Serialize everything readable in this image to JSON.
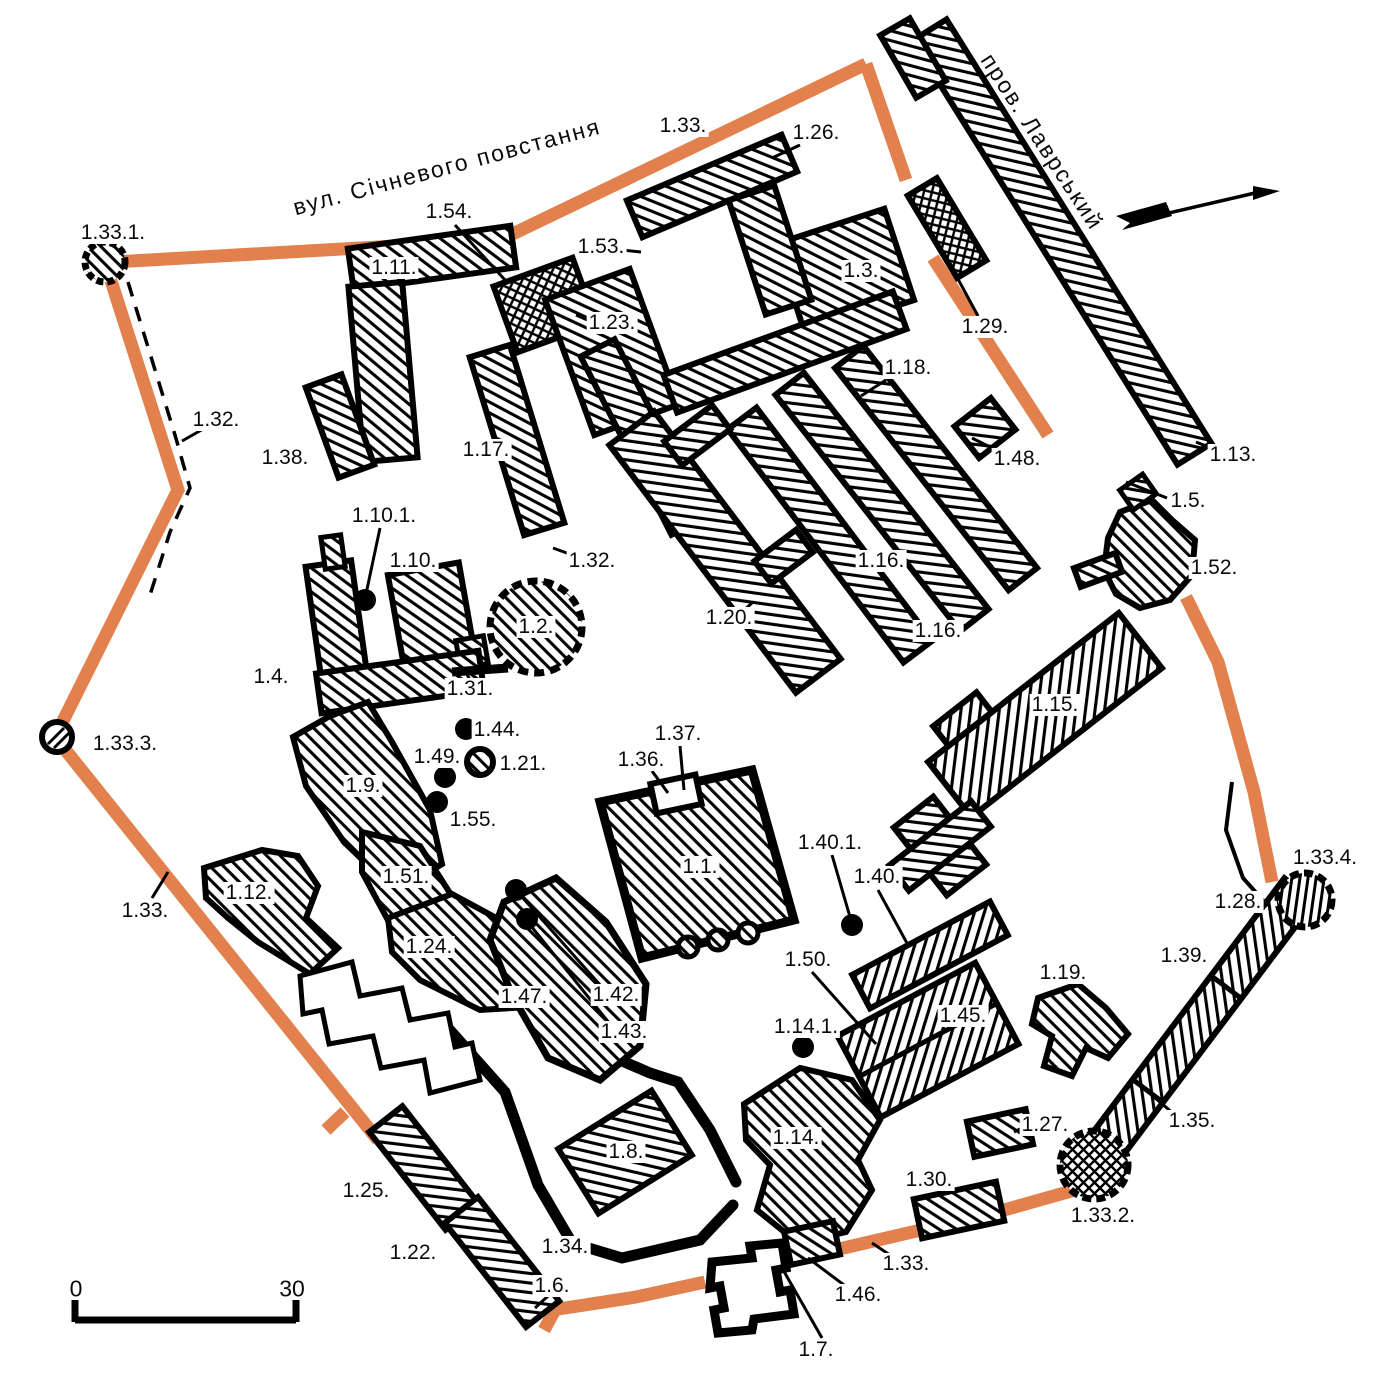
{
  "map": {
    "type": "architectural site plan",
    "colors": {
      "wall_orange": "#E2814E",
      "ink": "#000000",
      "background": "#FFFFFF"
    },
    "streets": [
      {
        "name": "вул. Січневого повстання",
        "x": 447,
        "y": 167,
        "angle": -15
      },
      {
        "name": "пров. Лаврський",
        "x": 1042,
        "y": 142,
        "angle": 57
      }
    ],
    "scale_bar": {
      "start": "0",
      "end": "30",
      "x0": 76,
      "x1": 292,
      "num_y": 1289,
      "bar_y": 1320
    },
    "north_arrow": {
      "present": true
    },
    "labels": [
      {
        "id": "1.33.1.",
        "x": 113,
        "y": 233
      },
      {
        "id": "1.54.",
        "x": 449,
        "y": 212
      },
      {
        "id": "1.33.",
        "x": 683,
        "y": 126
      },
      {
        "id": "1.26.",
        "x": 816,
        "y": 133
      },
      {
        "id": "1.53.",
        "x": 601,
        "y": 247
      },
      {
        "id": "1.11.",
        "x": 394,
        "y": 268
      },
      {
        "id": "1.3.",
        "x": 861,
        "y": 271
      },
      {
        "id": "1.29.",
        "x": 985,
        "y": 327
      },
      {
        "id": "1.23.",
        "x": 612,
        "y": 323
      },
      {
        "id": "1.32.",
        "x": 216,
        "y": 420
      },
      {
        "id": "1.38.",
        "x": 285,
        "y": 458
      },
      {
        "id": "1.17.",
        "x": 486,
        "y": 450
      },
      {
        "id": "1.18.",
        "x": 908,
        "y": 368
      },
      {
        "id": "1.48.",
        "x": 1017,
        "y": 459
      },
      {
        "id": "1.13.",
        "x": 1233,
        "y": 455
      },
      {
        "id": "1.5.",
        "x": 1188,
        "y": 501
      },
      {
        "id": "1.10.1.",
        "x": 384,
        "y": 516
      },
      {
        "id": "1.10.",
        "x": 413,
        "y": 561
      },
      {
        "id": "1.32.",
        "x": 592,
        "y": 561
      },
      {
        "id": "1.52.",
        "x": 1214,
        "y": 568
      },
      {
        "id": "1.16.",
        "x": 881,
        "y": 561
      },
      {
        "id": "1.2.",
        "x": 536,
        "y": 627
      },
      {
        "id": "1.20.",
        "x": 729,
        "y": 618
      },
      {
        "id": "1.16.",
        "x": 938,
        "y": 631
      },
      {
        "id": "1.4.",
        "x": 271,
        "y": 677
      },
      {
        "id": "1.31.",
        "x": 470,
        "y": 689
      },
      {
        "id": "1.15.",
        "x": 1055,
        "y": 705
      },
      {
        "id": "1.44.",
        "x": 497,
        "y": 730
      },
      {
        "id": "1.49.",
        "x": 437,
        "y": 757
      },
      {
        "id": "1.21.",
        "x": 523,
        "y": 764
      },
      {
        "id": "1.37.",
        "x": 678,
        "y": 734
      },
      {
        "id": "1.36.",
        "x": 641,
        "y": 760
      },
      {
        "id": "1.55.",
        "x": 473,
        "y": 820
      },
      {
        "id": "1.9.",
        "x": 363,
        "y": 786
      },
      {
        "id": "1.33.3.",
        "x": 125,
        "y": 744
      },
      {
        "id": "1.1.",
        "x": 700,
        "y": 867
      },
      {
        "id": "1.40.1.",
        "x": 830,
        "y": 843
      },
      {
        "id": "1.40.",
        "x": 877,
        "y": 877
      },
      {
        "id": "1.51.",
        "x": 406,
        "y": 877
      },
      {
        "id": "1.33.",
        "x": 145,
        "y": 911
      },
      {
        "id": "1.12.",
        "x": 249,
        "y": 893
      },
      {
        "id": "1.24.",
        "x": 429,
        "y": 947
      },
      {
        "id": "1.50.",
        "x": 808,
        "y": 960
      },
      {
        "id": "1.42.",
        "x": 616,
        "y": 995
      },
      {
        "id": "1.47.",
        "x": 524,
        "y": 997
      },
      {
        "id": "1.43.",
        "x": 624,
        "y": 1032
      },
      {
        "id": "1.14.1.",
        "x": 806,
        "y": 1027
      },
      {
        "id": "1.45.",
        "x": 963,
        "y": 1016
      },
      {
        "id": "1.19.",
        "x": 1063,
        "y": 973
      },
      {
        "id": "1.28.",
        "x": 1238,
        "y": 902
      },
      {
        "id": "1.33.4.",
        "x": 1325,
        "y": 858
      },
      {
        "id": "1.39.",
        "x": 1184,
        "y": 956
      },
      {
        "id": "1.35.",
        "x": 1192,
        "y": 1121
      },
      {
        "id": "1.27.",
        "x": 1045,
        "y": 1125
      },
      {
        "id": "1.14.",
        "x": 796,
        "y": 1138
      },
      {
        "id": "1.30.",
        "x": 929,
        "y": 1180
      },
      {
        "id": "1.33.2.",
        "x": 1103,
        "y": 1216
      },
      {
        "id": "1.25.",
        "x": 366,
        "y": 1191
      },
      {
        "id": "1.8.",
        "x": 626,
        "y": 1152
      },
      {
        "id": "1.22.",
        "x": 413,
        "y": 1253
      },
      {
        "id": "1.34.",
        "x": 565,
        "y": 1247
      },
      {
        "id": "1.33.",
        "x": 906,
        "y": 1264
      },
      {
        "id": "1.46.",
        "x": 858,
        "y": 1295
      },
      {
        "id": "1.6.",
        "x": 552,
        "y": 1286
      },
      {
        "id": "1.7.",
        "x": 816,
        "y": 1350
      }
    ],
    "point_markers": [
      {
        "ref": "1.10.1.",
        "x": 365,
        "y": 600
      },
      {
        "ref": "1.44.",
        "x": 466,
        "y": 729
      },
      {
        "ref": "1.49.",
        "x": 445,
        "y": 777
      },
      {
        "ref": "1.55.",
        "x": 437,
        "y": 802
      },
      {
        "ref": "1.42.",
        "x": 516,
        "y": 890
      },
      {
        "ref": "1.43.",
        "x": 527,
        "y": 919
      },
      {
        "ref": "1.40.1.",
        "x": 852,
        "y": 925
      },
      {
        "ref": "1.14.1.",
        "x": 803,
        "y": 1047
      }
    ],
    "leader_lines": [
      {
        "ref": "1.32.",
        "x1": 205,
        "y1": 428,
        "x2": 182,
        "y2": 441
      },
      {
        "ref": "1.54.",
        "x1": 455,
        "y1": 225,
        "x2": 505,
        "y2": 280
      },
      {
        "ref": "1.10.1.",
        "x1": 380,
        "y1": 528,
        "x2": 366,
        "y2": 594
      },
      {
        "ref": "1.32.",
        "x1": 575,
        "y1": 556,
        "x2": 553,
        "y2": 548
      },
      {
        "ref": "1.26.",
        "x1": 800,
        "y1": 145,
        "x2": 772,
        "y2": 158
      },
      {
        "ref": "1.53.",
        "x1": 622,
        "y1": 250,
        "x2": 641,
        "y2": 252
      },
      {
        "ref": "1.23.",
        "x1": 592,
        "y1": 322,
        "x2": 576,
        "y2": 315
      },
      {
        "ref": "1.29.",
        "x1": 978,
        "y1": 316,
        "x2": 952,
        "y2": 268
      },
      {
        "ref": "1.13.",
        "x1": 1221,
        "y1": 452,
        "x2": 1196,
        "y2": 442
      },
      {
        "ref": "1.5.",
        "x1": 1167,
        "y1": 498,
        "x2": 1126,
        "y2": 482
      },
      {
        "ref": "1.18.",
        "x1": 886,
        "y1": 380,
        "x2": 861,
        "y2": 396
      },
      {
        "ref": "1.48.",
        "x1": 996,
        "y1": 450,
        "x2": 972,
        "y2": 438
      },
      {
        "ref": "1.20.",
        "x1": 742,
        "y1": 612,
        "x2": 753,
        "y2": 602
      },
      {
        "ref": "1.16.",
        "x1": 928,
        "y1": 642,
        "x2": 914,
        "y2": 656
      },
      {
        "ref": "1.31.",
        "x1": 470,
        "y1": 680,
        "x2": 463,
        "y2": 667
      },
      {
        "ref": "1.36.",
        "x1": 652,
        "y1": 771,
        "x2": 668,
        "y2": 793
      },
      {
        "ref": "1.37.",
        "x1": 680,
        "y1": 746,
        "x2": 684,
        "y2": 790
      },
      {
        "ref": "1.42.",
        "x1": 522,
        "y1": 897,
        "x2": 601,
        "y2": 986
      },
      {
        "ref": "1.43.",
        "x1": 531,
        "y1": 926,
        "x2": 610,
        "y2": 1024
      },
      {
        "ref": "1.40.1.",
        "x1": 832,
        "y1": 855,
        "x2": 850,
        "y2": 917
      },
      {
        "ref": "1.40.",
        "x1": 878,
        "y1": 890,
        "x2": 908,
        "y2": 945
      },
      {
        "ref": "1.50.",
        "x1": 812,
        "y1": 972,
        "x2": 876,
        "y2": 1044
      },
      {
        "ref": "1.7.",
        "x1": 782,
        "y1": 1268,
        "x2": 822,
        "y2": 1338
      },
      {
        "ref": "1.46.",
        "x1": 808,
        "y1": 1258,
        "x2": 848,
        "y2": 1288
      },
      {
        "ref": "1.33.",
        "x1": 893,
        "y1": 1257,
        "x2": 872,
        "y2": 1243
      },
      {
        "ref": "1.33.",
        "x1": 152,
        "y1": 898,
        "x2": 168,
        "y2": 872
      },
      {
        "ref": "1.6.",
        "x1": 548,
        "y1": 1296,
        "x2": 535,
        "y2": 1308
      },
      {
        "ref": "1.27.",
        "x1": 1030,
        "y1": 1124,
        "x2": 1014,
        "y2": 1132
      },
      {
        "ref": "1.35.",
        "x1": 1174,
        "y1": 1114,
        "x2": 1148,
        "y2": 1092
      },
      {
        "ref": "1.33.3.",
        "x1": 140,
        "y1": 743,
        "x2": 110,
        "y2": 739
      }
    ]
  }
}
